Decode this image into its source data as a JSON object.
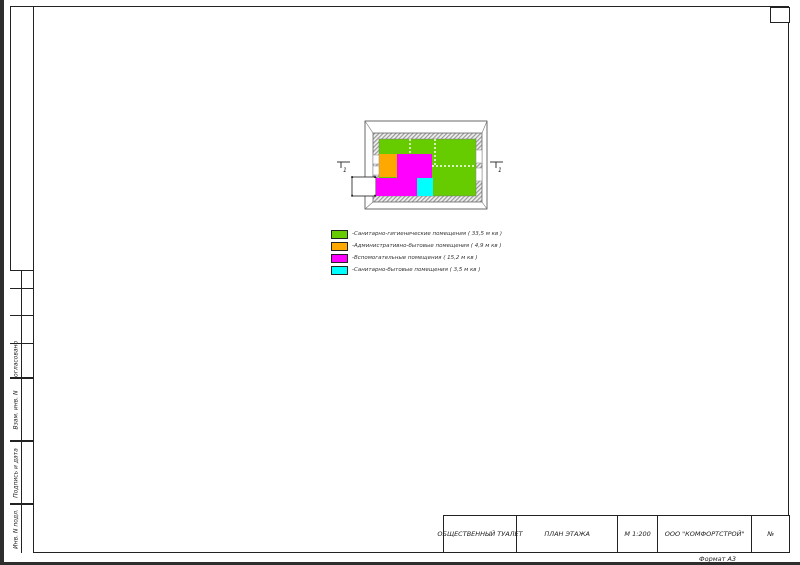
{
  "sheet": {
    "format_note": "Формат А3",
    "title_block": {
      "columns": [
        {
          "label": "ОБЩЕСТВЕННЫЙ ТУАЛЕТ"
        },
        {
          "label": "ПЛАН ЭТАЖА"
        },
        {
          "label": "М 1:200"
        },
        {
          "label": "ООО \"КОМФОРТСТРОЙ\""
        },
        {
          "label": "№"
        }
      ]
    },
    "stamp_rows": [
      {
        "label": "Согласовано"
      },
      {
        "label": "Взам. инв. N"
      },
      {
        "label": "Подпись и дата"
      },
      {
        "label": "Инв. N подл."
      }
    ],
    "legend": {
      "items": [
        {
          "color": "#66CC00",
          "label": "-Санитарно-гигиенические помещения ( 33,5 м кв )"
        },
        {
          "color": "#FFA800",
          "label": "-Административно-бытовые помещения ( 4,9 м кв )"
        },
        {
          "color": "#FF00FF",
          "label": "-Вспомогательные помещения ( 15,2 м кв )"
        },
        {
          "color": "#00FFFF",
          "label": "-Санитарно-бытовые помещения ( 3,5 м кв )"
        }
      ]
    },
    "plan": {
      "colors": {
        "sanitary_hygienic": "#66CC00",
        "administrative": "#FFA800",
        "auxiliary": "#FF00FF",
        "sanitary_domestic": "#00FFFF"
      },
      "section_mark_left": "1",
      "section_mark_right": "1"
    }
  }
}
